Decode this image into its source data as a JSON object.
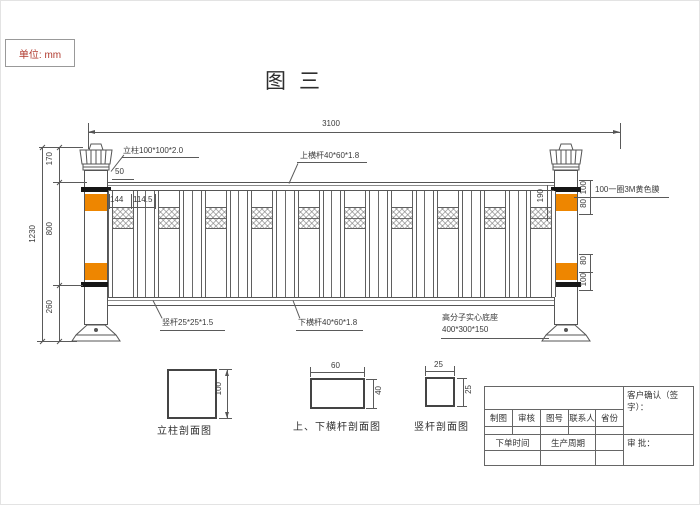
{
  "unit_label": "单位: mm",
  "figure_title": "图三",
  "drawing": {
    "dim_total": "3100",
    "dim_gap": "50",
    "dim_144": "144",
    "dim_114_5": "114.5",
    "dim_cap": "170",
    "dim_mid": "800",
    "dim_base": "260",
    "dim_height": "1230",
    "dim_190": "190",
    "dim_top_band_upper": "100",
    "dim_top_band_lower": "80",
    "dim_bot_band_upper": "80",
    "dim_bot_band_lower": "100",
    "label_post": "立柱100*100*2.0",
    "label_top_rail": "上横杆40*60*1.8",
    "label_vbar": "竖杆25*25*1.5",
    "label_bottom_rail": "下横杆40*60*1.8",
    "label_base_line1": "高分子实心底座",
    "label_base_line2": "400*300*150",
    "label_film": "100一圈3M黄色膜",
    "colors": {
      "reflective_band": "#ee8600",
      "post_band": "#161616"
    }
  },
  "sections": {
    "post": {
      "label": "立柱剖面图",
      "dim_side": "100"
    },
    "rail": {
      "label": "上、下横杆剖面图",
      "dim_top": "60",
      "dim_side": "40"
    },
    "vbar": {
      "label": "竖杆剖面图",
      "dim_top": "25",
      "dim_side": "25"
    }
  },
  "titleblock": {
    "confirm": "客户确认（签字）：",
    "approve": "审 批：",
    "headers": [
      "制图",
      "审核",
      "图号",
      "联系人",
      "省份"
    ],
    "order_time": "下单时间",
    "cycle": "生产周期"
  }
}
